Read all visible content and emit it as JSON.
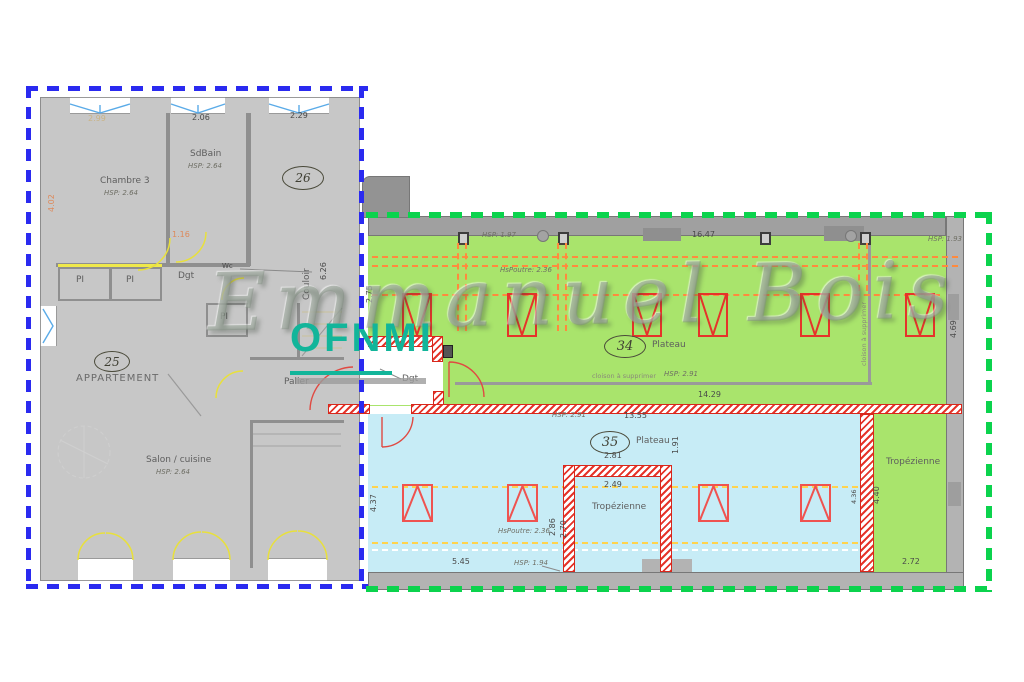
{
  "brand": {
    "script": "Emmanuel Bois",
    "name": "OFNMI"
  },
  "apartment": {
    "unit_number": "25",
    "unit_label": "APPARTEMENT",
    "chambre3": "Chambre 3",
    "chambre3_hsp": "HSP: 2.64",
    "sdbain": "SdBain",
    "sdbain_hsp": "HSP: 2.64",
    "salon": "Salon / cuisine",
    "salon_hsp": "HSP: 2.64",
    "palier": "Palier",
    "dgt": "Dgt",
    "wc": "Wc",
    "pi": "PI",
    "couloir_number": "26",
    "couloir": "Couloir",
    "couloir_length": "6.26",
    "dim_win1": "2.99",
    "dim_win2": "2.06",
    "dim_win3": "2.29",
    "dim_dgt": "1.16",
    "dim_left": "4.02"
  },
  "plateau34": {
    "number": "34",
    "label": "Plateau",
    "hsp": "HSP: 2.91",
    "hsp_front": "HSP: 1.97",
    "hsp_right": "HSP: 1.93",
    "beam": "HsPoutre: 2.36",
    "dim_top": "16.47",
    "dim_inner": "14.29",
    "dim_left": "2.75",
    "dim_right": "4.69",
    "cloison": "cloison à supprimer",
    "cloison_v": "cloison à supprimer",
    "dgt": "Dgt"
  },
  "plateau35": {
    "number": "35",
    "label": "Plateau",
    "hsp": "HSP: 2.91",
    "hsp_front": "HSP: 1.94",
    "beam": "HsPoutre: 2.36",
    "dim_top": "13.55",
    "dim_bottom": "5.45",
    "dim_left": "4.37",
    "dim_right": "4.36",
    "dim_mid": "1.91",
    "tropezienne": "Tropézienne",
    "dim_trop_out": "2.81",
    "dim_trop_in": "2.49",
    "dim_trop_h1": "2.86",
    "dim_trop_h2": "2.70"
  },
  "troproom": {
    "label": "Tropézienne",
    "dim_h": "4.40",
    "dim_w": "2.72"
  },
  "colors": {
    "apartment_boundary": "#2a2af0",
    "plateau_boundary": "#0bd34d",
    "plateau34_fill": "#a9e46c",
    "plateau35_fill": "#c7ecf6",
    "couloir_fill": "#f6efc3",
    "structure_red": "#e5342a",
    "beam_orange": "#ff8a3d",
    "brand_teal": "#12b59a"
  }
}
